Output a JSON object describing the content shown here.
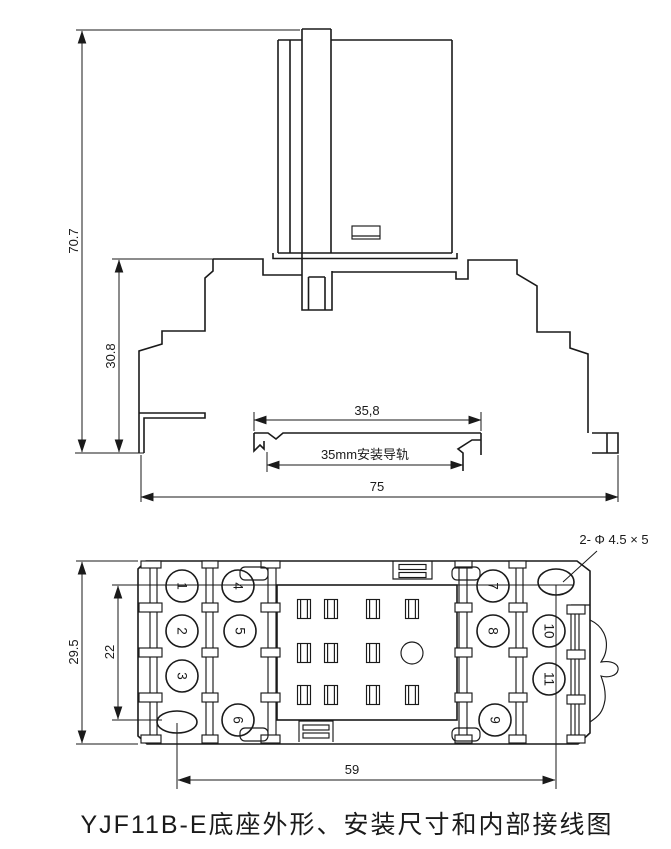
{
  "colors": {
    "line": "#1a1a1a",
    "background": "#ffffff"
  },
  "side_view": {
    "dims": {
      "overall_height": "70.7",
      "socket_height": "30.8",
      "rail_top_width": "35,8",
      "rail_label": "35mm安装导轨",
      "overall_width": "75"
    }
  },
  "plan_view": {
    "dims": {
      "height": "29.5",
      "terminal_row_span": "22",
      "hole_span": "59"
    },
    "hole_note": "2- Φ 4.5 × 5",
    "terminals": [
      "1",
      "2",
      "3",
      "4",
      "5",
      "6",
      "7",
      "8",
      "9",
      "10",
      "11"
    ]
  },
  "caption": "YJF11B-E底座外形、安装尺寸和内部接线图"
}
